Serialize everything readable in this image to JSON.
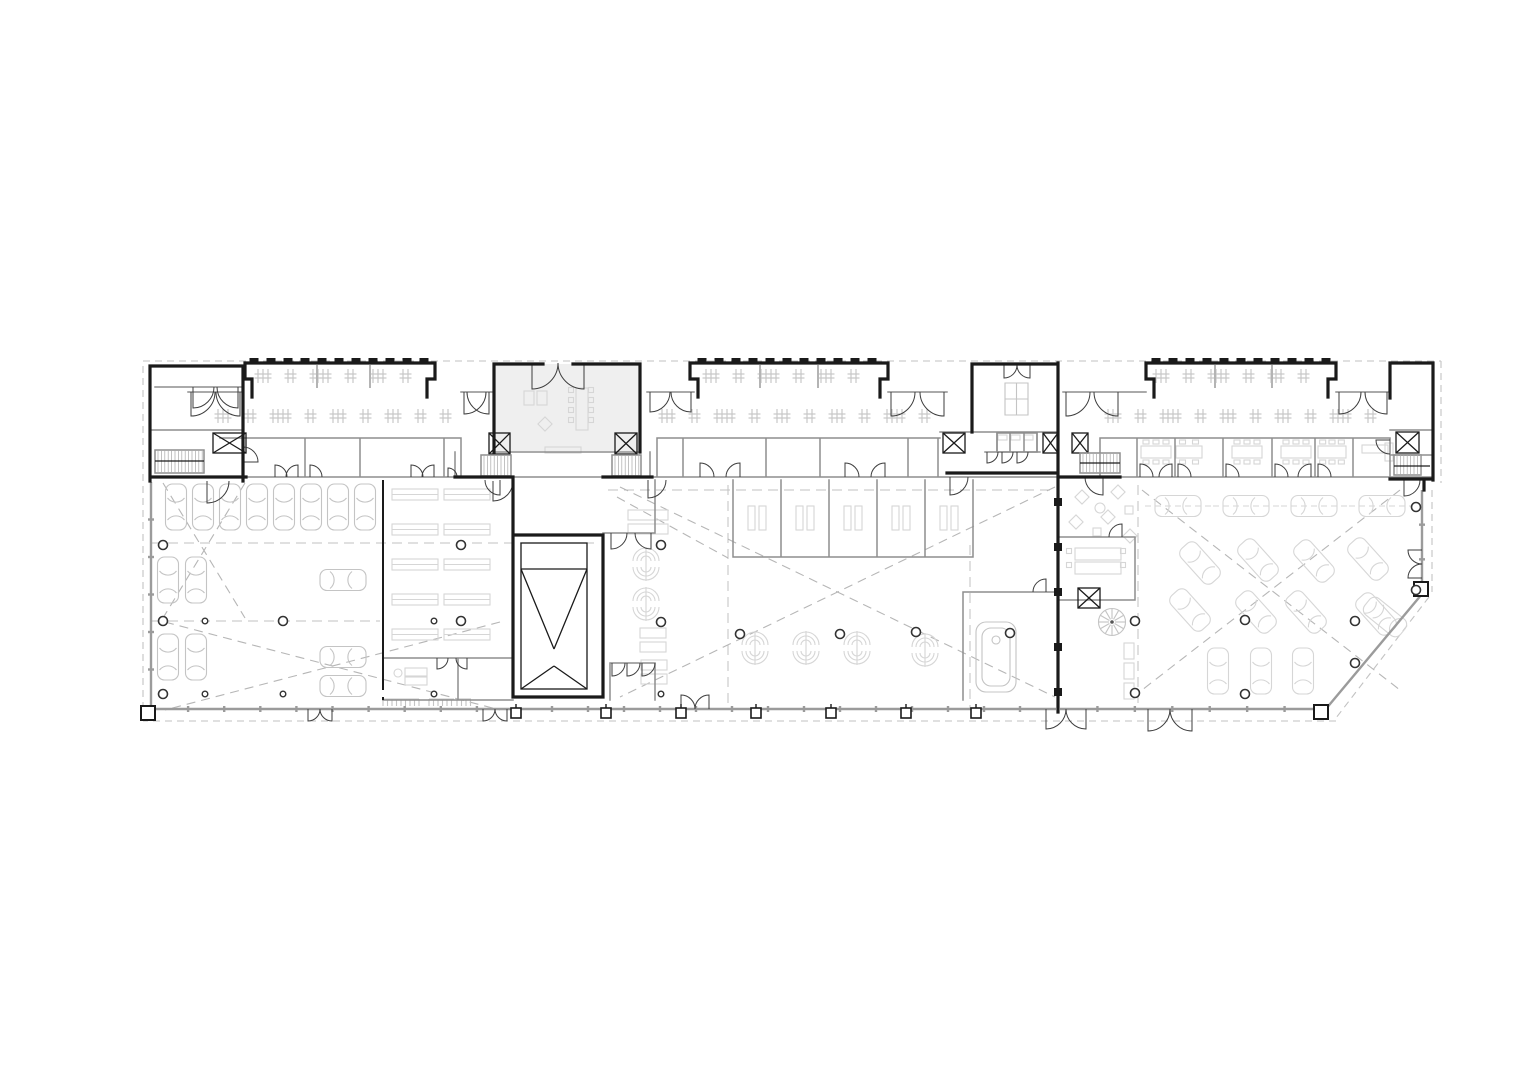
{
  "meta": {
    "kind": "architectural-floor-plan",
    "canvas": {
      "w": 1528,
      "h": 1080
    }
  },
  "palette": {
    "bg": "#ffffff",
    "wallDark": "#1a1a1a",
    "wallMid": "#8e8e8e",
    "glass": "#9b9b9b",
    "furn": "#c4c4c4",
    "furnLight": "#d6d6d6",
    "dash": "#c2c2c2",
    "aisle": "#b6b6b6",
    "column": "#333333"
  },
  "canopy_segs": [
    [
      143,
      361,
      1441,
      361
    ],
    [
      1441,
      361,
      1441,
      483
    ],
    [
      1432,
      490,
      1432,
      592
    ],
    [
      1429,
      597,
      1336,
      718
    ],
    [
      1336,
      721,
      143,
      721
    ],
    [
      143,
      721,
      143,
      361
    ]
  ],
  "grid_dashes": [
    [
      728,
      485,
      728,
      708
    ],
    [
      970,
      545,
      970,
      708
    ],
    [
      1138,
      485,
      1138,
      708
    ],
    [
      152,
      543,
      600,
      543
    ],
    [
      152,
      621,
      380,
      621
    ],
    [
      608,
      490,
      1056,
      490
    ]
  ],
  "aisle_dashes": [
    [
      163,
      483,
      245,
      618
    ],
    [
      245,
      483,
      163,
      618
    ],
    [
      165,
      622,
      500,
      710
    ],
    [
      500,
      622,
      165,
      710
    ],
    [
      620,
      487,
      1055,
      697
    ],
    [
      1055,
      487,
      620,
      697
    ],
    [
      1142,
      490,
      1400,
      690
    ],
    [
      1400,
      490,
      1142,
      690
    ],
    [
      617,
      497,
      728,
      558
    ]
  ],
  "glass_segs": [
    [
      152,
      709,
      513,
      709
    ],
    [
      516,
      709,
      1056,
      709
    ],
    [
      1060,
      709,
      1322,
      709
    ],
    [
      151,
      482,
      151,
      707
    ],
    [
      1325,
      710,
      1422,
      594
    ],
    [
      1422,
      594,
      1422,
      490
    ]
  ],
  "cars": [
    [
      176,
      507,
      0,
      0,
      0
    ],
    [
      203,
      507,
      0,
      0,
      0
    ],
    [
      230,
      507,
      0,
      0,
      0
    ],
    [
      257,
      507,
      0,
      0,
      0
    ],
    [
      284,
      507,
      0,
      0,
      0
    ],
    [
      311,
      507,
      0,
      0,
      0
    ],
    [
      338,
      507,
      0,
      0,
      0
    ],
    [
      365,
      507,
      0,
      0,
      0
    ],
    [
      168,
      580,
      0,
      0,
      0
    ],
    [
      196,
      580,
      0,
      0,
      0
    ],
    [
      168,
      657,
      0,
      0,
      0
    ],
    [
      196,
      657,
      0,
      0,
      0
    ],
    [
      343,
      580,
      90,
      0,
      0
    ],
    [
      343,
      657,
      90,
      0,
      0
    ],
    [
      343,
      686,
      90,
      0,
      0
    ],
    [
      1178,
      506,
      90,
      1,
      1
    ],
    [
      1246,
      506,
      90,
      1,
      1
    ],
    [
      1314,
      506,
      90,
      1,
      1
    ],
    [
      1382,
      506,
      90,
      1,
      1
    ],
    [
      1200,
      563,
      -42,
      1,
      0
    ],
    [
      1258,
      560,
      -42,
      1,
      0
    ],
    [
      1314,
      561,
      -42,
      1,
      0
    ],
    [
      1368,
      559,
      -42,
      1,
      0
    ],
    [
      1190,
      610,
      -42,
      1,
      0
    ],
    [
      1256,
      612,
      -42,
      1,
      0
    ],
    [
      1306,
      612,
      -42,
      1,
      0
    ],
    [
      1376,
      614,
      -42,
      1,
      0
    ],
    [
      1218,
      671,
      0,
      1,
      0
    ],
    [
      1261,
      671,
      0,
      1,
      0
    ],
    [
      1303,
      671,
      0,
      1,
      0
    ],
    [
      1385,
      617,
      -51,
      1,
      0
    ]
  ],
  "columns_large": [
    [
      163,
      545
    ],
    [
      163,
      621
    ],
    [
      283,
      621
    ],
    [
      461,
      545
    ],
    [
      461,
      621
    ],
    [
      661,
      545
    ],
    [
      661,
      622
    ],
    [
      740,
      634
    ],
    [
      840,
      634
    ],
    [
      916,
      632
    ],
    [
      1010,
      633
    ],
    [
      1135,
      621
    ],
    [
      1135,
      693
    ],
    [
      1245,
      620
    ],
    [
      1245,
      694
    ],
    [
      1355,
      621
    ],
    [
      1355,
      663
    ],
    [
      1416,
      507
    ],
    [
      1416,
      590
    ],
    [
      163,
      694
    ]
  ],
  "columns_small": [
    [
      205,
      621
    ],
    [
      205,
      694
    ],
    [
      283,
      694
    ],
    [
      434,
      694
    ],
    [
      434,
      621
    ],
    [
      661,
      694
    ]
  ],
  "bike_rows": [
    {
      "y": 376,
      "x1": 258,
      "x2": 420
    },
    {
      "y": 376,
      "x1": 706,
      "x2": 876
    },
    {
      "y": 376,
      "x1": 1156,
      "x2": 1324
    },
    {
      "y": 416,
      "x1": 218,
      "x2": 450
    },
    {
      "y": 416,
      "x1": 662,
      "x2": 930
    },
    {
      "y": 416,
      "x1": 1108,
      "x2": 1380
    }
  ],
  "pier_rows": [
    {
      "y": 358,
      "x1": 254,
      "x2": 424,
      "step": 17
    },
    {
      "y": 358,
      "x1": 702,
      "x2": 878,
      "step": 17
    },
    {
      "y": 358,
      "x1": 1156,
      "x2": 1326,
      "step": 17
    }
  ],
  "bottom_piers": [
    516,
    606,
    681,
    756,
    831,
    906,
    976
  ],
  "corner_squares": [
    [
      148,
      713
    ],
    [
      1321,
      712
    ],
    [
      1421,
      589
    ]
  ],
  "elevators": [
    [
      213,
      433,
      33,
      20
    ],
    [
      489,
      433,
      21,
      21
    ],
    [
      615,
      433,
      22,
      21
    ],
    [
      943,
      433,
      22,
      20
    ],
    [
      1043,
      433,
      15,
      20
    ],
    [
      1072,
      433,
      16,
      20
    ],
    [
      1396,
      432,
      23,
      21
    ],
    [
      1078,
      588,
      22,
      20
    ]
  ],
  "stairs": [
    [
      155,
      450,
      49,
      23
    ],
    [
      481,
      455,
      30,
      21
    ],
    [
      612,
      455,
      29,
      21
    ],
    [
      1080,
      453,
      40,
      20
    ],
    [
      1394,
      455,
      27,
      20
    ]
  ],
  "doors": [
    [
      191,
      392,
      0,
      1,
      1,
      0,
      24
    ],
    [
      240,
      392,
      0,
      1,
      -1,
      0,
      24
    ],
    [
      464,
      392,
      0,
      1,
      1,
      0,
      22
    ],
    [
      489,
      392,
      0,
      1,
      -1,
      0,
      22
    ],
    [
      650,
      392,
      0,
      1,
      1,
      0,
      20
    ],
    [
      691,
      392,
      0,
      1,
      -1,
      0,
      20
    ],
    [
      891,
      392,
      0,
      1,
      1,
      0,
      24
    ],
    [
      944,
      392,
      0,
      1,
      -1,
      0,
      24
    ],
    [
      1066,
      392,
      0,
      1,
      1,
      0,
      24
    ],
    [
      1118,
      392,
      0,
      1,
      -1,
      0,
      24
    ],
    [
      1339,
      392,
      0,
      1,
      1,
      0,
      22
    ],
    [
      1387,
      392,
      0,
      1,
      -1,
      0,
      22
    ],
    [
      532,
      363,
      0,
      1,
      1,
      0,
      26
    ],
    [
      584,
      363,
      0,
      1,
      -1,
      0,
      26
    ],
    [
      193,
      387,
      0,
      1,
      1,
      0,
      21
    ],
    [
      238,
      387,
      0,
      1,
      -1,
      0,
      21
    ],
    [
      207,
      481,
      0,
      1,
      1,
      0,
      22
    ],
    [
      243,
      462,
      1,
      0,
      0,
      -1,
      15
    ],
    [
      493,
      481,
      0,
      1,
      1,
      0,
      20
    ],
    [
      648,
      480,
      0,
      1,
      1,
      0,
      18
    ],
    [
      611,
      533,
      0,
      1,
      1,
      0,
      16
    ],
    [
      651,
      533,
      0,
      1,
      -1,
      0,
      16
    ],
    [
      612,
      663,
      0,
      1,
      1,
      0,
      13
    ],
    [
      627,
      663,
      0,
      1,
      1,
      0,
      13
    ],
    [
      642,
      663,
      0,
      1,
      1,
      0,
      13
    ],
    [
      437,
      658,
      0,
      1,
      1,
      0,
      11
    ],
    [
      467,
      658,
      0,
      1,
      -1,
      0,
      11
    ],
    [
      500,
      480,
      0,
      1,
      -1,
      0,
      15
    ],
    [
      1004,
      365,
      0,
      1,
      1,
      0,
      13
    ],
    [
      1030,
      365,
      0,
      1,
      -1,
      0,
      13
    ],
    [
      987,
      452,
      0,
      1,
      1,
      0,
      11
    ],
    [
      1002,
      452,
      0,
      1,
      1,
      0,
      11
    ],
    [
      1017,
      452,
      0,
      1,
      1,
      0,
      11
    ],
    [
      950,
      477,
      0,
      1,
      1,
      0,
      18
    ],
    [
      1103,
      477,
      0,
      1,
      -1,
      0,
      18
    ],
    [
      1390,
      440,
      -1,
      0,
      0,
      1,
      14
    ],
    [
      1404,
      480,
      0,
      1,
      1,
      0,
      16
    ],
    [
      1122,
      537,
      0,
      -1,
      -1,
      0,
      13
    ],
    [
      1046,
      592,
      0,
      -1,
      -1,
      0,
      13
    ],
    [
      1140,
      477,
      0,
      -1,
      1,
      0,
      13
    ],
    [
      1178,
      477,
      0,
      -1,
      1,
      0,
      13
    ],
    [
      1226,
      477,
      0,
      -1,
      1,
      0,
      13
    ],
    [
      1275,
      477,
      0,
      -1,
      1,
      0,
      13
    ],
    [
      1318,
      477,
      0,
      -1,
      1,
      0,
      13
    ],
    [
      1172,
      477,
      0,
      -1,
      -1,
      0,
      13
    ],
    [
      1311,
      477,
      0,
      -1,
      -1,
      0,
      13
    ],
    [
      700,
      477,
      0,
      -1,
      1,
      0,
      14
    ],
    [
      740,
      477,
      0,
      -1,
      -1,
      0,
      14
    ],
    [
      845,
      477,
      0,
      -1,
      1,
      0,
      14
    ],
    [
      885,
      477,
      0,
      -1,
      -1,
      0,
      14
    ],
    [
      275,
      477,
      0,
      -1,
      1,
      0,
      12
    ],
    [
      298,
      477,
      0,
      -1,
      -1,
      0,
      12
    ],
    [
      310,
      477,
      0,
      -1,
      1,
      0,
      12
    ],
    [
      411,
      477,
      0,
      -1,
      1,
      0,
      12
    ],
    [
      434,
      477,
      0,
      -1,
      -1,
      0,
      12
    ],
    [
      448,
      477,
      0,
      -1,
      1,
      0,
      9
    ],
    [
      308,
      709,
      0,
      1,
      1,
      0,
      12
    ],
    [
      332,
      709,
      0,
      1,
      -1,
      0,
      12
    ],
    [
      483,
      709,
      0,
      1,
      1,
      0,
      12
    ],
    [
      507,
      709,
      0,
      1,
      -1,
      0,
      12
    ],
    [
      681,
      709,
      0,
      -1,
      1,
      0,
      14
    ],
    [
      709,
      709,
      0,
      -1,
      -1,
      0,
      14
    ],
    [
      1046,
      709,
      0,
      1,
      1,
      0,
      20
    ],
    [
      1086,
      709,
      0,
      1,
      -1,
      0,
      20
    ],
    [
      1148,
      709,
      0,
      1,
      1,
      0,
      22
    ],
    [
      1192,
      709,
      0,
      1,
      -1,
      0,
      22
    ],
    [
      1422,
      550,
      -1,
      0,
      0,
      1,
      14
    ],
    [
      1422,
      578,
      -1,
      0,
      0,
      -1,
      14
    ]
  ],
  "meeting_tables": [
    [
      1156,
      452,
      30
    ],
    [
      1189,
      452,
      26
    ],
    [
      1247,
      452,
      30
    ],
    [
      1296,
      452,
      30
    ],
    [
      1332,
      452,
      28
    ]
  ],
  "stall_benches": [
    [
      757,
      518
    ],
    [
      805,
      518
    ],
    [
      853,
      518
    ],
    [
      901,
      518
    ],
    [
      949,
      518
    ]
  ],
  "clusters": [
    [
      646,
      564
    ],
    [
      646,
      604
    ],
    [
      755,
      648
    ],
    [
      806,
      648
    ],
    [
      857,
      648
    ],
    [
      925,
      650
    ]
  ],
  "workshop_benches": [
    [
      392,
      489
    ],
    [
      444,
      489
    ],
    [
      392,
      524
    ],
    [
      444,
      524
    ],
    [
      392,
      559
    ],
    [
      444,
      559
    ],
    [
      392,
      594
    ],
    [
      444,
      594
    ],
    [
      392,
      629
    ],
    [
      444,
      629
    ]
  ],
  "combs": [
    [
      383,
      699,
      36
    ],
    [
      429,
      699,
      25
    ],
    [
      457,
      699,
      14
    ]
  ],
  "furn_rects": [
    [
      628,
      510,
      40,
      10
    ],
    [
      628,
      524,
      40,
      10
    ],
    [
      640,
      628,
      26,
      10
    ],
    [
      640,
      642,
      26,
      10
    ],
    [
      641,
      660,
      26,
      10
    ],
    [
      641,
      674,
      26,
      10
    ],
    [
      524,
      391,
      10,
      14
    ],
    [
      537,
      391,
      10,
      14
    ],
    [
      576,
      388,
      12,
      42
    ],
    [
      545,
      447,
      36,
      6
    ],
    [
      1075,
      548,
      46,
      12
    ],
    [
      1075,
      562,
      46,
      12
    ],
    [
      1124,
      643,
      10,
      16
    ],
    [
      1124,
      663,
      10,
      16
    ],
    [
      1124,
      683,
      10,
      16
    ],
    [
      1093,
      528,
      8,
      8
    ],
    [
      1125,
      506,
      8,
      8
    ],
    [
      405,
      668,
      22,
      8
    ],
    [
      405,
      677,
      22,
      8
    ],
    [
      998,
      435,
      9,
      5
    ],
    [
      1011,
      435,
      9,
      5
    ],
    [
      1024,
      435,
      9,
      5
    ],
    [
      1362,
      445,
      26,
      8
    ],
    [
      1385,
      443,
      8,
      18
    ]
  ],
  "chair_sqs": [
    [
      571,
      390
    ],
    [
      571,
      400
    ],
    [
      571,
      410
    ],
    [
      571,
      420
    ],
    [
      591,
      390
    ],
    [
      591,
      400
    ],
    [
      591,
      410
    ],
    [
      591,
      420
    ],
    [
      1069,
      551
    ],
    [
      1069,
      565
    ],
    [
      1123,
      551
    ],
    [
      1123,
      565
    ]
  ],
  "diamonds": [
    [
      1082,
      497
    ],
    [
      1118,
      492
    ],
    [
      1076,
      522
    ],
    [
      1108,
      517
    ],
    [
      1130,
      536
    ],
    [
      545,
      424
    ]
  ],
  "lounge_circles": [
    [
      1100,
      508,
      5
    ],
    [
      398,
      673,
      4
    ]
  ],
  "spiral_stair": {
    "x": 1112,
    "y": 622,
    "r": 13.5,
    "spokes": 12
  },
  "party_squares": [
    [
      1058,
      502
    ],
    [
      1058,
      547
    ],
    [
      1058,
      592
    ],
    [
      1058,
      647
    ],
    [
      1058,
      692
    ]
  ],
  "wc_stalls": {
    "x1": 997,
    "x2": 1037,
    "y1": 433,
    "y2": 452,
    "cells": 3
  }
}
